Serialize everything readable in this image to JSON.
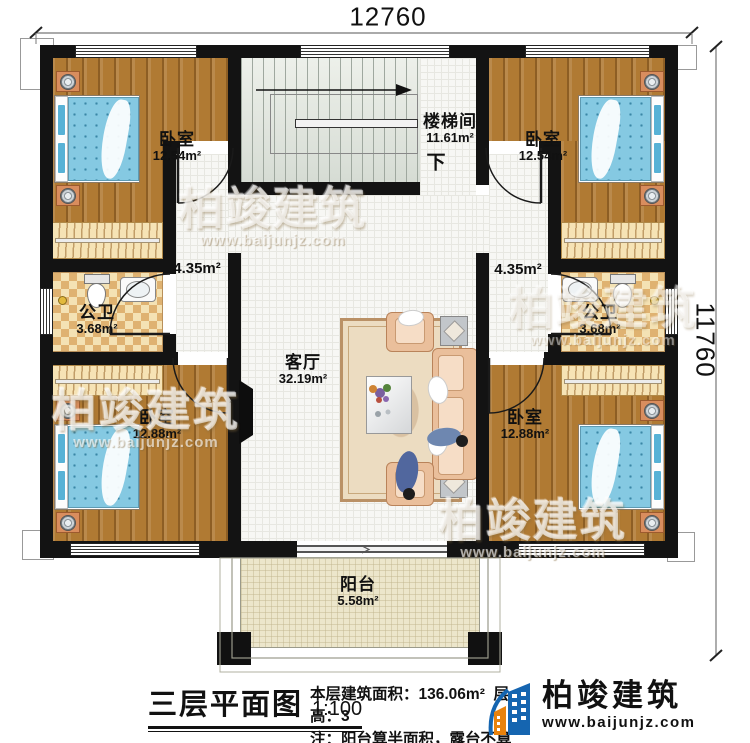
{
  "dimensions": {
    "width": "12760",
    "height": "11760"
  },
  "rooms": {
    "bedroom_tl": {
      "name": "卧室",
      "area": "12.54m²"
    },
    "bedroom_tr": {
      "name": "卧室",
      "area": "12.54m²"
    },
    "stairwell": {
      "name": "楼梯间",
      "area": "11.61m²",
      "direction": "下"
    },
    "corridor_left": {
      "area": "4.35m²"
    },
    "corridor_right": {
      "area": "4.35m²"
    },
    "bathroom_left": {
      "name": "公卫",
      "area": "3.68m²"
    },
    "bathroom_right": {
      "name": "公卫",
      "area": "3.68m²"
    },
    "living_room": {
      "name": "客厅",
      "area": "32.19m²"
    },
    "bedroom_bl": {
      "name": "卧室",
      "area": "12.88m²"
    },
    "bedroom_br": {
      "name": "卧室",
      "area": "12.88m²"
    },
    "balcony": {
      "name": "阳台",
      "area": "5.58m²"
    }
  },
  "title_block": {
    "title": "三层平面图",
    "scale": "1:100",
    "area_text": "本层建筑面积：136.06m²",
    "floor_height_text": "层高：3",
    "note_text": "注：阳台算半面积，露台不算面积"
  },
  "branding": {
    "company": "柏竣建筑",
    "website": "www.baijunjz.com",
    "watermark_name": "柏竣建筑",
    "watermark_url": "www.baijunjz.com"
  },
  "colors": {
    "wall": "#131313",
    "wood_floor": "#b07a33",
    "tile_floor": "#f7f7f4",
    "bathroom_check": "#dfb271",
    "stair_floor": "#e2e6e0",
    "balcony_floor": "#ece6cb",
    "bed_blue": "#85c9e2",
    "logo_blue": "#1565b0",
    "logo_orange": "#e8820c"
  }
}
